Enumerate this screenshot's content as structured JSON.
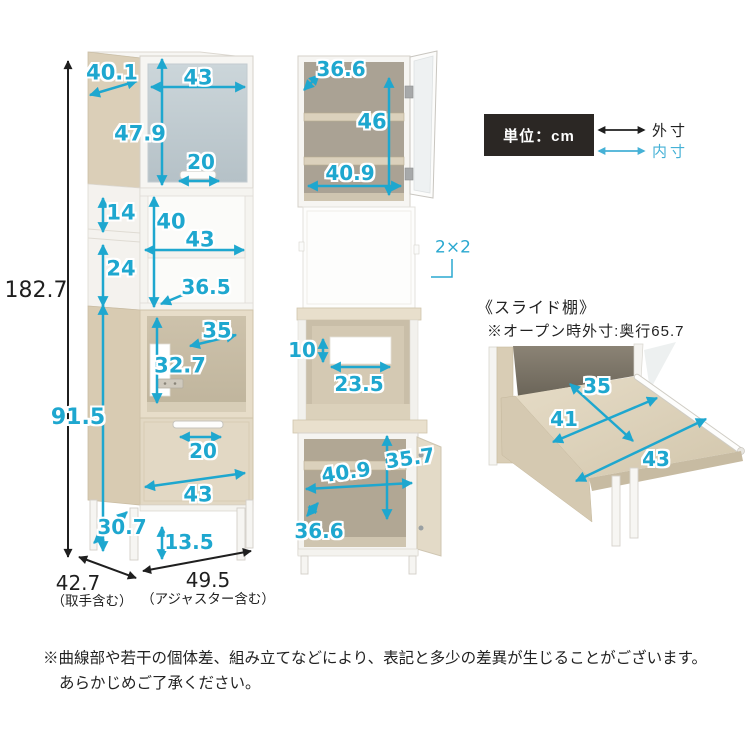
{
  "legend": {
    "unit": "単位：cm",
    "outer": "外寸",
    "inner": "内寸"
  },
  "front_view": {
    "total_height": "182.7",
    "top_depth": "40.1",
    "top_width": "43",
    "glass_height": "47.9",
    "glass_handle": "20",
    "side_gap_upper": "14",
    "shelf_inner_height": "40",
    "shelf_inner_width": "43",
    "side_gap_lower": "24",
    "shelf_inner_depth": "36.5",
    "oven_inner_width": "35",
    "oven_inner_height": "32.7",
    "lower_height": "91.5",
    "drawer_handle": "20",
    "drawer_width": "43",
    "base_depth": "30.7",
    "leg_height": "13.5",
    "total_depth": "42.7",
    "total_depth_note": "（取手含む）",
    "total_width": "49.5",
    "total_width_note": "（アジャスター含む）"
  },
  "open_view": {
    "upper_depth": "36.6",
    "upper_height": "46",
    "upper_width": "40.9",
    "outlet": "2×2",
    "hole_height": "10",
    "hole_width": "23.5",
    "lower_width": "40.9",
    "lower_height": "35.7",
    "lower_depth": "36.6"
  },
  "slide_shelf": {
    "title": "《スライド棚》",
    "note": "※オープン時外寸:奥行65.7",
    "depth": "35",
    "inner_width": "41",
    "outer_width": "43"
  },
  "disclaimer": {
    "line1": "※曲線部や若干の個体差、組み立てなどにより、表記と多少の差異が生じることがございます。",
    "line2": "あらかじめご了承ください。"
  },
  "colors": {
    "dimension_inner": "#1ea7cf",
    "dimension_outer": "#1f1f1f",
    "legend_bg": "#2b2724",
    "wood": "#dbcfb8",
    "glass": "#c3ccd2"
  }
}
